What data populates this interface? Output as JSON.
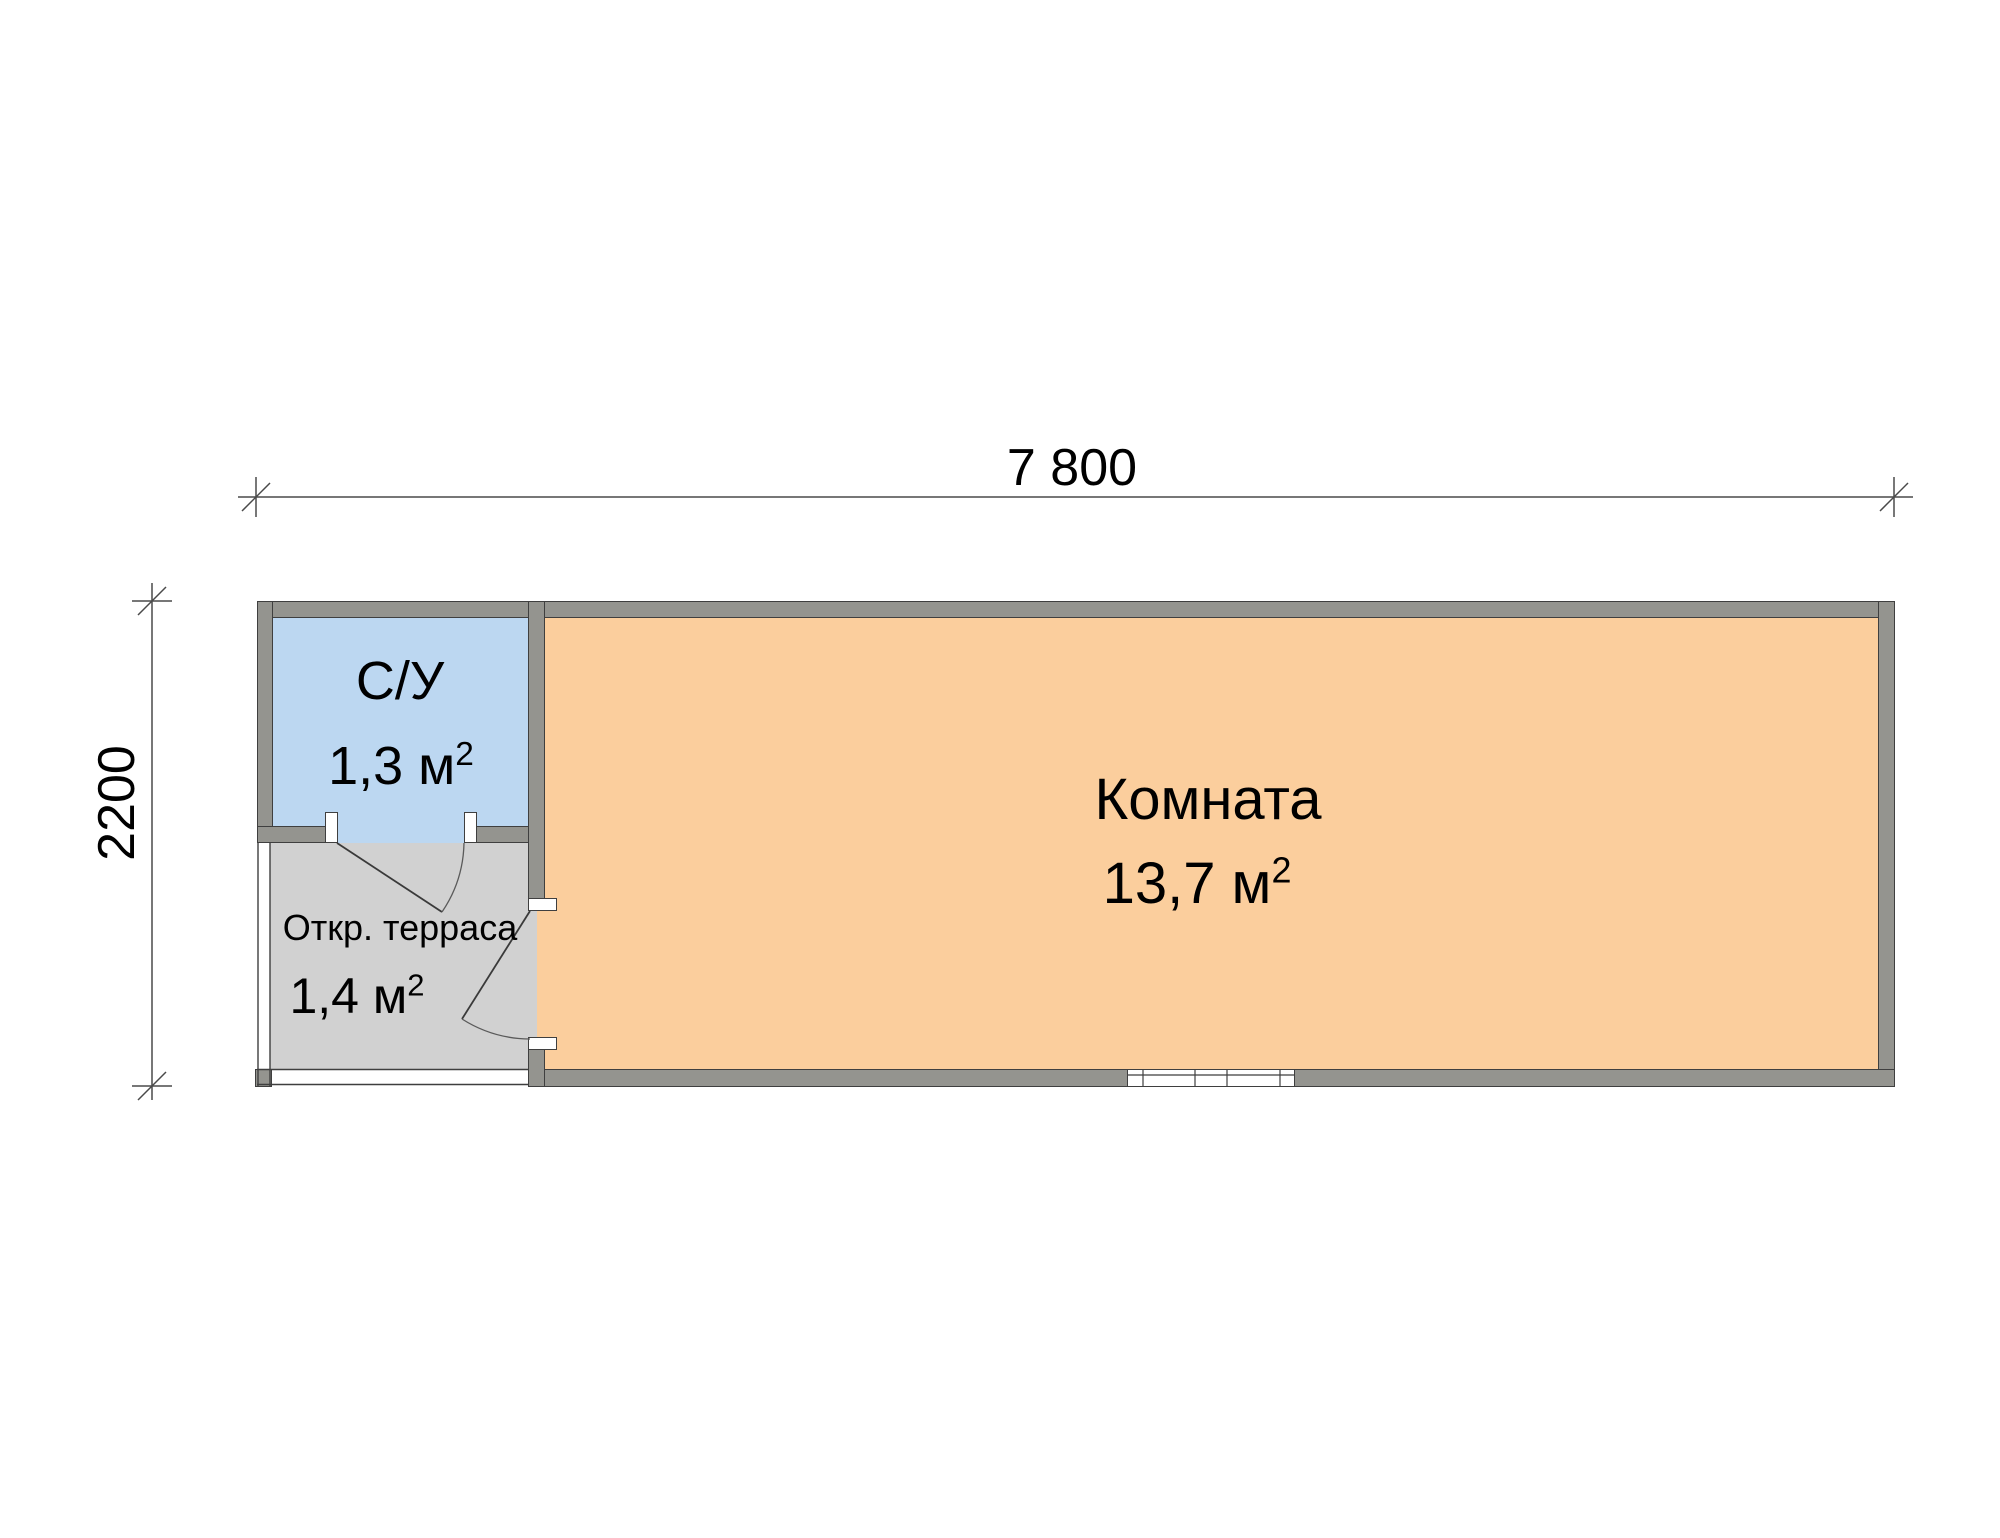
{
  "plan": {
    "dimensions": {
      "width_label": "7 800",
      "height_label": "2200"
    },
    "rooms": {
      "bathroom": {
        "name": "С/У",
        "area": "1,3 м",
        "area_exp": "2"
      },
      "living": {
        "name": "Комната",
        "area": "13,7 м",
        "area_exp": "2"
      },
      "terrace": {
        "name": "Откр. терраса",
        "area": "1,4 м",
        "area_exp": "2"
      }
    },
    "colors": {
      "wall_fill": "#94948f",
      "wall_edge": "#3f3f3f",
      "bathroom_fill": "#bcd7f1",
      "living_fill": "#fbce9d",
      "terrace_fill": "#d1d1d1",
      "dimension_line": "#4a4a4a",
      "text": "#000000"
    }
  }
}
